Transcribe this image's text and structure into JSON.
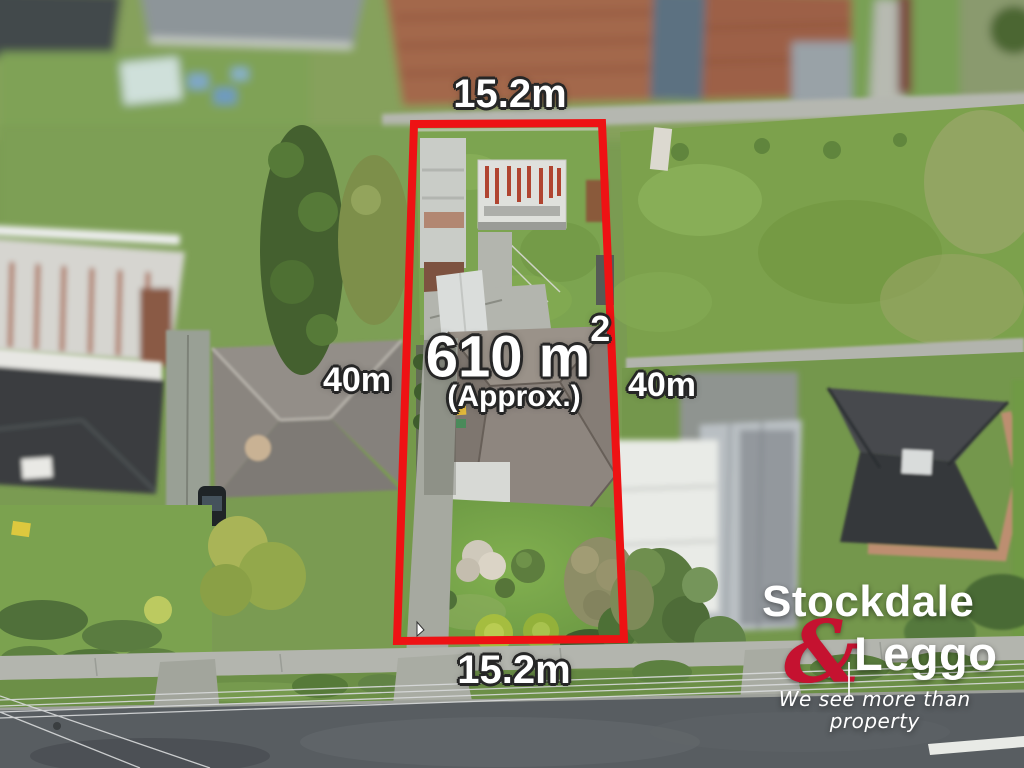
{
  "annotations": {
    "top_dimension": "15.2m",
    "bottom_dimension": "15.2m",
    "left_dimension": "40m",
    "right_dimension": "40m",
    "area_value": "610 m",
    "area_superscript": "2",
    "area_qualifier": "(Approx.)"
  },
  "logo": {
    "line1": "Stockdale",
    "ampersand": "&",
    "line2": "Leggo",
    "tagline": "We see more than property"
  },
  "colors": {
    "boundary-red": "#ee1214",
    "brand-red": "#c51230",
    "label-white": "#ffffff",
    "label-outline": "#262626"
  }
}
